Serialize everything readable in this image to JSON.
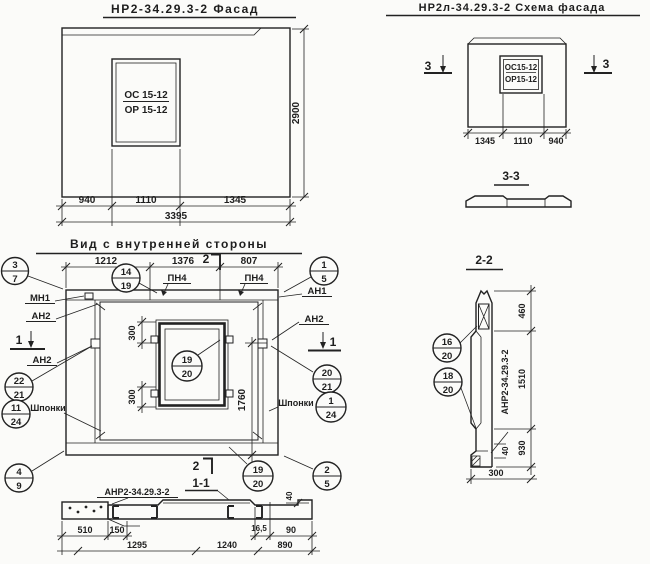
{
  "drawing": {
    "facade": {
      "title": "НР2-34.29.3-2 Фасад",
      "window": {
        "top": "ОС 15-12",
        "bottom": "ОР 15-12"
      },
      "dim_940": "940",
      "dim_1110": "1110",
      "dim_1345": "1345",
      "dim_total": "3395",
      "dim_height": "2900"
    },
    "scheme": {
      "title": "НР2л-34.29.3-2 Схема фасада",
      "window": {
        "top": "ОС15-12",
        "bottom": "ОР15-12"
      },
      "section_mark": "3",
      "dim_1345": "1345",
      "dim_1110": "1110",
      "dim_940": "940",
      "section_title": "3-3"
    },
    "inner": {
      "title": "Вид с внутренней стороны",
      "dim_1212": "1212",
      "dim_1376": "1376",
      "dim_807": "807",
      "dim_300": "300",
      "dim_1760": "1760",
      "cut2": "2",
      "cut1": "1",
      "cut11": "1-1",
      "label_mn1": "МН1",
      "label_an1": "АН1",
      "label_an2": "АН2",
      "label_pn4": "ПН4",
      "label_shponki": "Шпонки",
      "c37": {
        "top": "3",
        "bottom": "7"
      },
      "c1419": {
        "top": "14",
        "bottom": "19"
      },
      "c15": {
        "top": "1",
        "bottom": "5"
      },
      "c2221": {
        "top": "22",
        "bottom": "21"
      },
      "c1124": {
        "top": "11",
        "bottom": "24"
      },
      "c49": {
        "top": "4",
        "bottom": "9"
      },
      "c1920": {
        "top": "19",
        "bottom": "20"
      },
      "c2021": {
        "top": "20",
        "bottom": "21"
      },
      "c124": {
        "top": "1",
        "bottom": "24"
      },
      "c25": {
        "top": "2",
        "bottom": "5"
      }
    },
    "sec11": {
      "label": "АНР2-34.29.3-2",
      "dim_510": "510",
      "dim_150": "150",
      "dim_165": "16,5",
      "dim_90": "90",
      "dim_1295": "1295",
      "dim_1240": "1240",
      "dim_890": "890",
      "dim_40": "40"
    },
    "sec22": {
      "title": "2-2",
      "label": "АНР2-34.29.3-2",
      "dim_460": "460",
      "dim_1510": "1510",
      "dim_930": "930",
      "dim_40": "40",
      "dim_300": "300",
      "c1620": {
        "top": "16",
        "bottom": "20"
      },
      "c1820": {
        "top": "18",
        "bottom": "20"
      }
    }
  }
}
